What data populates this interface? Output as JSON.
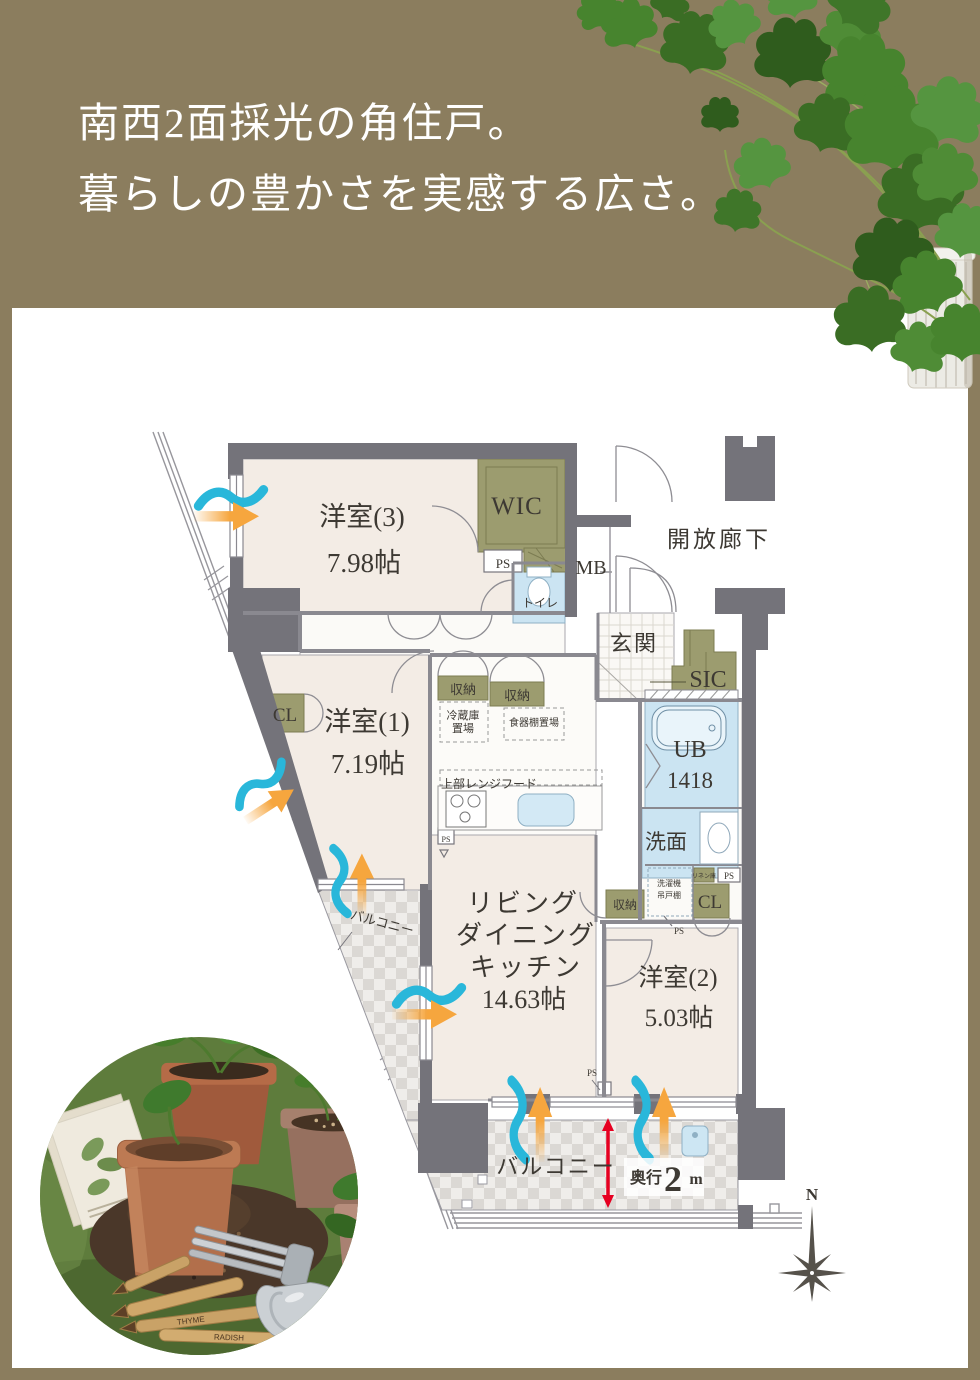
{
  "header": {
    "title_line1": "南西2面採光の角住戸。",
    "title_line2": "暮らしの豊かさを実感する広さ。"
  },
  "colors": {
    "banner_olive": "#8b7d5e",
    "wall_gray": "#74737a",
    "room_cream": "#f3ece5",
    "closet_olive": "#9c9c6f",
    "wet_blue": "#cbe4f2",
    "airflow_cyan": "#29b7da",
    "airflow_orange": "#f6a63e",
    "annotation_red": "#e60021",
    "text_dark": "#3d3933"
  },
  "plan": {
    "labels": [
      {
        "id": "room3-name",
        "text": "洋室(3)",
        "x": 362,
        "y": 526,
        "size": 27
      },
      {
        "id": "room3-size",
        "text": "7.98帖",
        "x": 364,
        "y": 572,
        "size": 27
      },
      {
        "id": "wic-label",
        "text": "WIC",
        "x": 517,
        "y": 514,
        "size": 25,
        "spacing": 1
      },
      {
        "id": "ps-top-label",
        "text": "PS",
        "x": 503,
        "y": 568,
        "size": 13
      },
      {
        "id": "toilet-label",
        "text": "トイレ",
        "x": 540,
        "y": 607,
        "size": 12
      },
      {
        "id": "mb-label",
        "text": "MB",
        "x": 591,
        "y": 574,
        "size": 20
      },
      {
        "id": "corridor-label",
        "text": "開放廊下",
        "x": 719,
        "y": 547,
        "size": 23,
        "spacing": 3
      },
      {
        "id": "genkan-label",
        "text": "玄関",
        "x": 634,
        "y": 651,
        "size": 22,
        "spacing": 2
      },
      {
        "id": "sic-label",
        "text": "SIC",
        "x": 708,
        "y": 687,
        "size": 24
      },
      {
        "id": "storage-kitchen-1",
        "text": "収納",
        "x": 463,
        "y": 694,
        "size": 13
      },
      {
        "id": "storage-kitchen-2",
        "text": "収納",
        "x": 517,
        "y": 700,
        "size": 13
      },
      {
        "id": "fridge-line1",
        "text": "冷蔵庫",
        "x": 463,
        "y": 719,
        "size": 11
      },
      {
        "id": "fridge-line2",
        "text": "置場",
        "x": 463,
        "y": 732,
        "size": 11
      },
      {
        "id": "cupboard-label",
        "text": "食器棚置場",
        "x": 534,
        "y": 726,
        "size": 10
      },
      {
        "id": "rangehood-label",
        "text": "上部レンジフード",
        "x": 489,
        "y": 788,
        "size": 12
      },
      {
        "id": "cl-west-label",
        "text": "CL",
        "x": 285,
        "y": 721,
        "size": 19
      },
      {
        "id": "room1-name",
        "text": "洋室(1)",
        "x": 367,
        "y": 731,
        "size": 27
      },
      {
        "id": "room1-size",
        "text": "7.19帖",
        "x": 368,
        "y": 773,
        "size": 27
      },
      {
        "id": "ub-label",
        "text": "UB",
        "x": 690,
        "y": 757,
        "size": 24
      },
      {
        "id": "ub-size-label",
        "text": "1418",
        "x": 690,
        "y": 788,
        "size": 23
      },
      {
        "id": "senmen-label",
        "text": "洗面",
        "x": 666,
        "y": 849,
        "size": 21
      },
      {
        "id": "washer-line1",
        "text": "洗濯機",
        "x": 669,
        "y": 886,
        "size": 8
      },
      {
        "id": "washer-line2",
        "text": "吊戸棚",
        "x": 669,
        "y": 898,
        "size": 8
      },
      {
        "id": "linen-label",
        "text": "リネン庫",
        "x": 704,
        "y": 878,
        "size": 6
      },
      {
        "id": "ps-mid-label",
        "text": "PS",
        "x": 729,
        "y": 879,
        "size": 9
      },
      {
        "id": "cl-east-label",
        "text": "CL",
        "x": 710,
        "y": 908,
        "size": 19
      },
      {
        "id": "storage-east-label",
        "text": "収納",
        "x": 625,
        "y": 909,
        "size": 12
      },
      {
        "id": "ps-small-label",
        "text": "PS",
        "x": 679,
        "y": 934,
        "size": 9
      },
      {
        "id": "ldk-line1",
        "text": "リビング",
        "x": 523,
        "y": 912,
        "size": 26,
        "spacing": 2
      },
      {
        "id": "ldk-line2",
        "text": "ダイニング",
        "x": 526,
        "y": 944,
        "size": 26,
        "spacing": 2
      },
      {
        "id": "ldk-line3",
        "text": "キッチン",
        "x": 526,
        "y": 976,
        "size": 26,
        "spacing": 2
      },
      {
        "id": "ldk-size",
        "text": "14.63帖",
        "x": 524,
        "y": 1008,
        "size": 26
      },
      {
        "id": "room2-name",
        "text": "洋室(2)",
        "x": 678,
        "y": 986,
        "size": 25
      },
      {
        "id": "room2-size",
        "text": "5.03帖",
        "x": 679,
        "y": 1026,
        "size": 25
      },
      {
        "id": "balcony-side-label",
        "text": "バルコニー",
        "x": 381,
        "y": 927,
        "size": 13,
        "rotate": 15
      },
      {
        "id": "balcony-main-label",
        "text": "バルコニー",
        "x": 556,
        "y": 1174,
        "size": 22,
        "spacing": 2
      },
      {
        "id": "ps-kitchen-label",
        "text": "PS",
        "x": 446,
        "y": 842,
        "size": 8
      },
      {
        "id": "ps-bottom-label",
        "text": "PS",
        "x": 592,
        "y": 1076,
        "size": 9
      },
      {
        "id": "depth-prefix",
        "text": "奥行",
        "x": 646,
        "y": 1183,
        "size": 16,
        "color": "#e60021",
        "bold": true
      },
      {
        "id": "depth-value",
        "text": "2",
        "x": 673,
        "y": 1191,
        "size": 36,
        "color": "#e60021",
        "bold": true
      },
      {
        "id": "depth-unit",
        "text": "m",
        "x": 696,
        "y": 1184,
        "size": 16,
        "color": "#e60021",
        "bold": true
      },
      {
        "id": "compass-n-label",
        "text": "N",
        "x": 812,
        "y": 1200,
        "size": 17,
        "bold": true
      }
    ]
  },
  "photo": {
    "labels": [
      {
        "id": "marker-text-1",
        "text": "THYME",
        "x": 152,
        "y": 288,
        "size": 8,
        "rotate": -7,
        "color": "#4a3520"
      },
      {
        "id": "marker-text-2",
        "text": "RADISH",
        "x": 190,
        "y": 305,
        "size": 8,
        "rotate": 2,
        "color": "#4a3520"
      }
    ]
  }
}
